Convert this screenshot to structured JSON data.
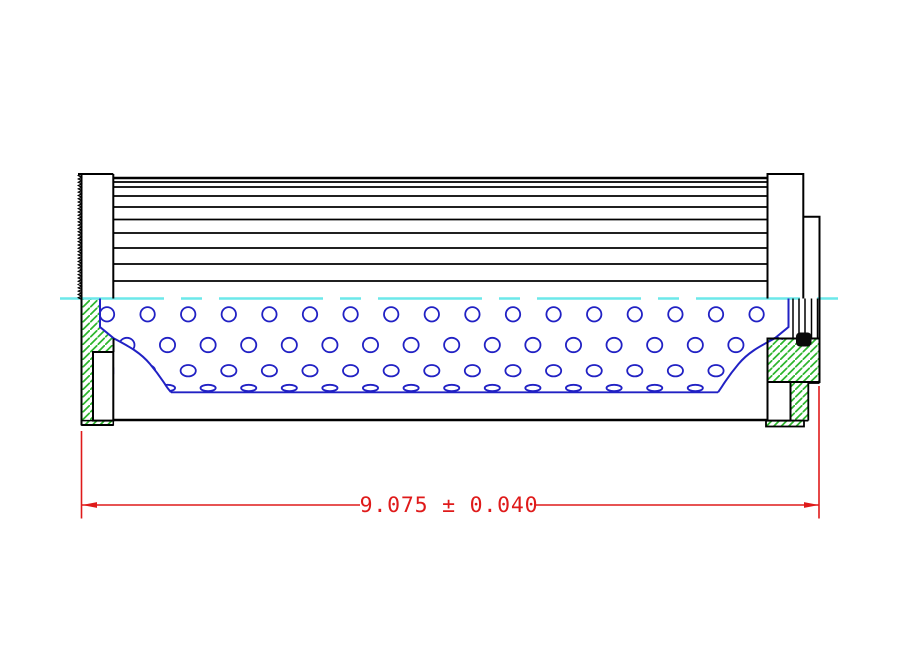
{
  "canvas": {
    "w": 916,
    "h": 664,
    "background": "#ffffff"
  },
  "colors": {
    "outline": "#000000",
    "core_tube_blue": "#2121c4",
    "centerline_cyan": "#6ce8ea",
    "end_cap_hatch_green": "#2db52d",
    "dimension_red": "#df1a1a",
    "seal_black": "#0a0a0a",
    "fill_white": "#ffffff"
  },
  "dimension": {
    "label": "9.075 ± 0.040",
    "value": "9.075",
    "tolerance": "0.040",
    "line_y": 505,
    "text_center_x": 449,
    "text_baseline_y": 512,
    "font_size": 21.5,
    "left_arrow_x": 82,
    "right_arrow_x": 819,
    "left_seg_end": 360,
    "right_seg_start": 534,
    "arrow_len": 15,
    "arrow_half_w": 2.9,
    "ext_left": {
      "x": 81.5,
      "y1": 431,
      "y2": 518.5
    },
    "ext_right": {
      "x": 819,
      "y1": 386,
      "y2": 518.5
    },
    "line_w": 1.6
  },
  "centerline": {
    "y": 298.5,
    "x1": 60,
    "x2": 844,
    "width": 2.6,
    "dash": "104 17 21 17"
  },
  "pleats": {
    "x1": 113.3,
    "x2": 767.5,
    "top_lines": [
      {
        "y": 178,
        "w": 2.4
      },
      {
        "y": 182,
        "w": 1.8
      }
    ],
    "fold_lines": [
      187,
      196,
      207,
      219.5,
      233,
      248,
      264,
      281
    ],
    "fold_w": 1.7,
    "bottom_edge_y": 420,
    "bottom_edge_w": 2.4
  },
  "perforations": {
    "step": 40.6,
    "stroke_w": 1.8,
    "rows": [
      {
        "y": 314.3,
        "rx": 7.2,
        "ry": 7.2,
        "x0": 107,
        "xmax": 762
      },
      {
        "y": 345.0,
        "rx": 7.6,
        "ry": 7.2,
        "x0": 126.9,
        "xmax": 782
      },
      {
        "y": 370.7,
        "rx": 7.6,
        "ry": 5.7,
        "x0": 107,
        "xmax": 762
      },
      {
        "y": 388.0,
        "rx": 7.6,
        "ry": 3.2,
        "x0": 126.9,
        "xmax": 742
      }
    ]
  },
  "liner": {
    "left_white_poly": "M114,338.5 C128,346 140,352 150,364 C158,373.5 163,381 166.5,386.5 C168.5,389.5 170,391 171,392.3 L171,419 L114.5,419 Z",
    "right_white_poly": "M774.5,338.5 C760.5,346 748.5,352 738.5,364 C730.5,373.5 725.5,381 722,386.5 C720,389.5 719,391 718,392.3 L718,419 L789,419 L789,341 Z",
    "left_curve": "M100,298.5 L100,327 L114,338.5 C128,346 140,352 150,364 C158,373.5 163,381 166.5,386.5 C168.5,389.5 170,391 171,392.3",
    "right_curve": "M788.5,298.5 L788.5,327 L774.5,338.5 C760.5,346 748.5,352 738.5,364 C730.5,373.5 725.5,381 722,386.5 C720,389.5 719,391 718,392.3",
    "tube_line": {
      "y": 392.3,
      "x1": 171,
      "x2": 718,
      "w": 1.9
    },
    "curve_w": 2
  },
  "left_cap": {
    "fill_rect": {
      "x": 81.5,
      "y": 174,
      "w": 31.8,
      "h": 124.5
    },
    "hatch_poly": "M81.5,298.5 L100,298.5 L100,327 L113.5,338.5 L113.5,352 L93,352 L93,420.6 L81.5,420.6 Z",
    "outline": [
      "M78,174 H113.3",
      "M81.5,174 V425",
      "M113.3,174 V298.5",
      "M81.5,425 H113.3",
      "M113.5,338.5 V352"
    ],
    "notch": {
      "x": 93,
      "y": 352,
      "w": 20.3,
      "h": 68.6
    },
    "strip": {
      "x": 81.5,
      "y": 420.6,
      "w": 31.8,
      "h": 4.4
    },
    "knurl": {
      "x_out": 78.2,
      "x_in": 81.5,
      "y1": 174,
      "y2": 299,
      "pitch": 3.3
    }
  },
  "right_cap": {
    "bar1_fill": {
      "x": 767.5,
      "y": 174,
      "w": 35.8,
      "h": 124.5
    },
    "bar2_fill": {
      "x": 803.3,
      "y": 216.7,
      "w": 16.2,
      "h": 81.8
    },
    "bar1_outline": "M767.5,298.5 L767.5,174 L803.3,174 L803.3,298.5",
    "bar2_outline": "M803.3,216.7 L819.5,216.7 L819.5,339",
    "hatch_block": {
      "x": 767.5,
      "y": 338.5,
      "w": 52,
      "h": 43.5
    },
    "leg": {
      "x": 790.5,
      "y": 382,
      "w": 17.8,
      "h": 38.6
    },
    "leg_outline": [
      "M808.3,383 V420.6",
      "M790.5,420.6 H808.3",
      "M808.3,383 H819.5"
    ],
    "notch": {
      "x": 767.5,
      "y": 382,
      "w": 23,
      "h": 38.6
    },
    "strip": {
      "x": 766,
      "y": 420.6,
      "w": 38,
      "h": 5.9
    },
    "seal_lines_x": [
      793,
      799,
      805,
      811.5,
      817.5
    ],
    "seal_lines_y1": 298.5,
    "seal_lines_y2": 338.5,
    "oring": {
      "x": 796,
      "y": 332.5,
      "w": 15.5,
      "h": 14,
      "rx": 4
    }
  },
  "hatch_pattern": {
    "size": 7.5,
    "line_w": 1.7
  }
}
